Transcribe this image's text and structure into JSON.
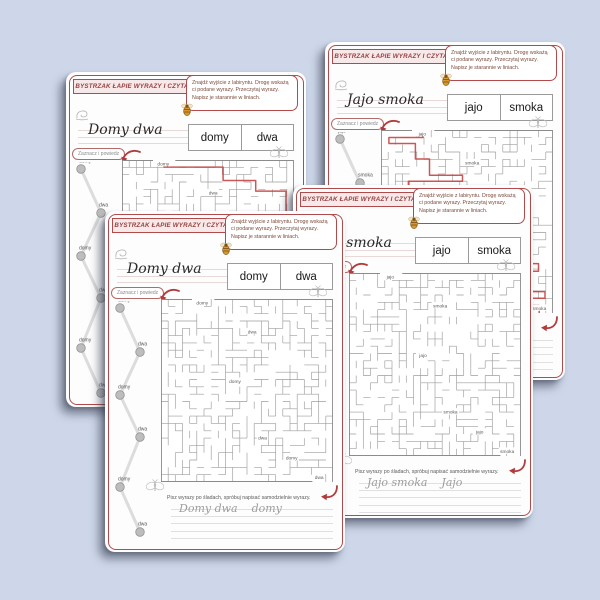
{
  "background_color": "#cdd7e9",
  "accent_red": "#b14a4a",
  "solution_path_red": "#c64545",
  "pages": [
    {
      "id": "back-left",
      "header": "BYSTRZAK ŁAPIE WYRAZY I CZYTA",
      "instructions": "Znajdź wyjście z labiryntu. Drogę wskażą ci podane wyrazy. Przeczytaj wyrazy. Napisz je starannie w liniach.",
      "handwriting_word": "Domy dwa",
      "word_boxes": [
        "domy",
        "dwa"
      ],
      "mark_label": "Zaznacz i powiedz",
      "chain_words": [
        "domy",
        "dwa",
        "domy",
        "dwa",
        "domy",
        "dwa"
      ],
      "maze_words": [
        "domy",
        "dwa",
        "domy",
        "dwa",
        "domy",
        "dwa"
      ],
      "maze_solved": true,
      "bottom_instruction": "Pisz wyrazy po śladach, spróbuj napisać samodzielnie wyrazy.",
      "trace_words": "Domy dwa    domy"
    },
    {
      "id": "back-right",
      "header": "BYSTRZAK ŁAPIE WYRAZY I CZYTA",
      "instructions": "Znajdź wyjście z labiryntu. Drogę wskażą ci podane wyrazy. Przeczytaj wyrazy. Napisz je starannie w liniach.",
      "handwriting_word": "Jajo smoka",
      "word_boxes": [
        "jajo",
        "smoka"
      ],
      "mark_label": "Zaznacz i powiedz",
      "chain_words": [
        "jajo",
        "smoka",
        "jajo",
        "smoka",
        "jajo",
        "smoka"
      ],
      "maze_words": [
        "jajo",
        "smoka",
        "jajo",
        "smoka",
        "jajo",
        "smoka"
      ],
      "maze_solved": true,
      "bottom_instruction": "Pisz wyrazy po śladach, spróbuj napisać samodzielnie wyrazy.",
      "trace_words": "Jajo smoka    Jajo"
    },
    {
      "id": "front-right",
      "header": "BYSTRZAK ŁAPIE WYRAZY I CZYTA",
      "instructions": "Znajdź wyjście z labiryntu. Drogę wskażą ci podane wyrazy. Przeczytaj wyrazy. Napisz je starannie w liniach.",
      "handwriting_word": "Jajo smoka",
      "word_boxes": [
        "jajo",
        "smoka"
      ],
      "mark_label": "Zaznacz i powiedz",
      "chain_words": [
        "jajo",
        "smoka",
        "jajo",
        "smoka",
        "jajo",
        "smoka"
      ],
      "maze_words": [
        "jajo",
        "smoka",
        "jajo",
        "smoka",
        "jajo",
        "smoka"
      ],
      "maze_solved": false,
      "bottom_instruction": "Pisz wyrazy po śladach, spróbuj napisać samodzielnie wyrazy.",
      "trace_words": "Jajo smoka    Jajo"
    },
    {
      "id": "front-left",
      "header": "BYSTRZAK ŁAPIE WYRAZY I CZYTA",
      "instructions": "Znajdź wyjście z labiryntu. Drogę wskażą ci podane wyrazy. Przeczytaj wyrazy. Napisz je starannie w liniach.",
      "handwriting_word": "Domy dwa",
      "word_boxes": [
        "domy",
        "dwa"
      ],
      "mark_label": "Zaznacz i powiedz",
      "chain_words": [
        "domy",
        "dwa",
        "domy",
        "dwa",
        "domy",
        "dwa"
      ],
      "maze_words": [
        "domy",
        "dwa",
        "domy",
        "dwa",
        "domy",
        "dwa"
      ],
      "maze_solved": false,
      "bottom_instruction": "Pisz wyrazy po śladach, spróbuj napisać samodzielnie wyrazy.",
      "trace_words": "Domy dwa    domy"
    }
  ]
}
